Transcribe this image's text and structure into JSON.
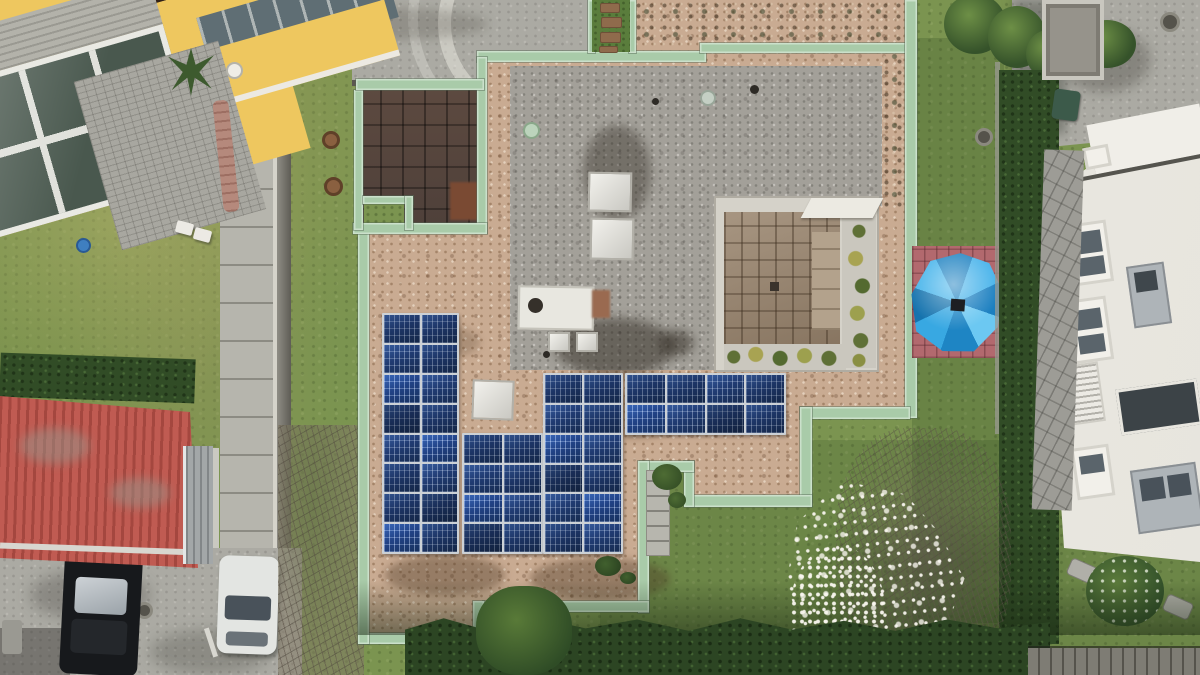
{
  "meta": {
    "type": "aerial-drone-photograph",
    "description": "Top-down aerial view of a flat-roof house with rooftop solar panels and a copper-edged roof, featuring a gravel roof, inner tiled courtyard, blue patio umbrella on pink tiles, surrounded by lawns, a yellow apartment building, a white villa, a red garage roof, parked cars, hedges and a blossoming magnolia tree."
  },
  "colors": {
    "grass_base": "#7b9450",
    "copper": "#a9cba9",
    "tan_gravel": "#c9ab92",
    "gray_gravel": "#a3a099",
    "yellow_bldg": "#eec75f",
    "umbrella_blue": "#2d9fdc",
    "patio_pink": "#b2696e",
    "red_roof": "#b8544c",
    "solar_panel": "#20386a",
    "white_villa": "#e7e5de"
  },
  "solar": {
    "panel_color": "#20386a",
    "total_panels": 44,
    "groups": [
      {
        "name": "west-array",
        "cols": 2,
        "rows": 8
      },
      {
        "name": "mid-array",
        "cols": 2,
        "rows": 4
      },
      {
        "name": "south-array",
        "cols": 2,
        "rows": 6
      },
      {
        "name": "east-band",
        "cols": 4,
        "rows": 2
      }
    ]
  },
  "labels": {
    "scene": "Aerial view of residential rooftop with solar panels",
    "main_roof": "Flat gravel roof with copper edging",
    "gray_roof": "Gray gravel roof section",
    "terrace": "Dark tiled roof terrace",
    "courtyard": "Sunken tiled courtyard with planters",
    "umbrella": "Blue patio umbrella",
    "pink_patio": "Pink tiled terrace",
    "solar_west": "Solar array west block",
    "solar_mid": "Solar array middle block",
    "solar_south": "Solar array south block",
    "solar_east": "Solar array east band",
    "skylight": "Roof skylight",
    "hvac": "Rooftop equipment box",
    "yellow_building": "Yellow apartment building with glass balconies",
    "white_villa": "White villa",
    "garage": "Red corrugated garage roof",
    "black_car": "Parked black car",
    "white_car": "Parked white car",
    "magnolia": "Blossoming magnolia tree",
    "hedge": "Garden hedge",
    "walkway": "Paved walkway",
    "driveway": "Concrete driveway",
    "lawn": "Lawn",
    "bin": "Green garden bin",
    "deck": "Wooden deck boards"
  }
}
